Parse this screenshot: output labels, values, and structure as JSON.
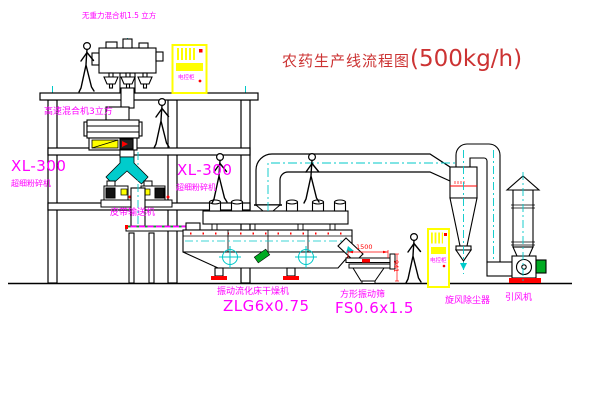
{
  "title": {
    "name": "农药生产线流程图",
    "capacity": "(500kg/h)"
  },
  "labels": {
    "gravity_free_mixer": "无重力混合机1.5 立方",
    "high_speed_mixer": "高速混合机3立方",
    "mill_left": {
      "model": "XL-300",
      "name": "超细粉碎机"
    },
    "mill_center": {
      "model": "XL-300",
      "name": "超细粉碎机"
    },
    "belt_conveyor": "皮带输送机",
    "dryer": {
      "name": "振动流化床干燥机",
      "model": "ZLG6x0.75"
    },
    "sieve": {
      "name": "方形振动筛",
      "model": "FS0.6x1.5"
    },
    "cyclone": "旋风除尘器",
    "fan": "引风机",
    "control_cabinet_top": "电控柜",
    "control_cabinet_right": "电控柜"
  },
  "dimensions": {
    "sieve_width": "1500",
    "sieve_height": "941"
  },
  "colors": {
    "line": "#000000",
    "centerline_cyan": "#00c8c8",
    "label_magenta": "#ff00ff",
    "accent_red": "#ff0000",
    "cabinet_yellow": "#ffff00",
    "motor_green": "#00aa22",
    "title_red": "#cc3333"
  }
}
